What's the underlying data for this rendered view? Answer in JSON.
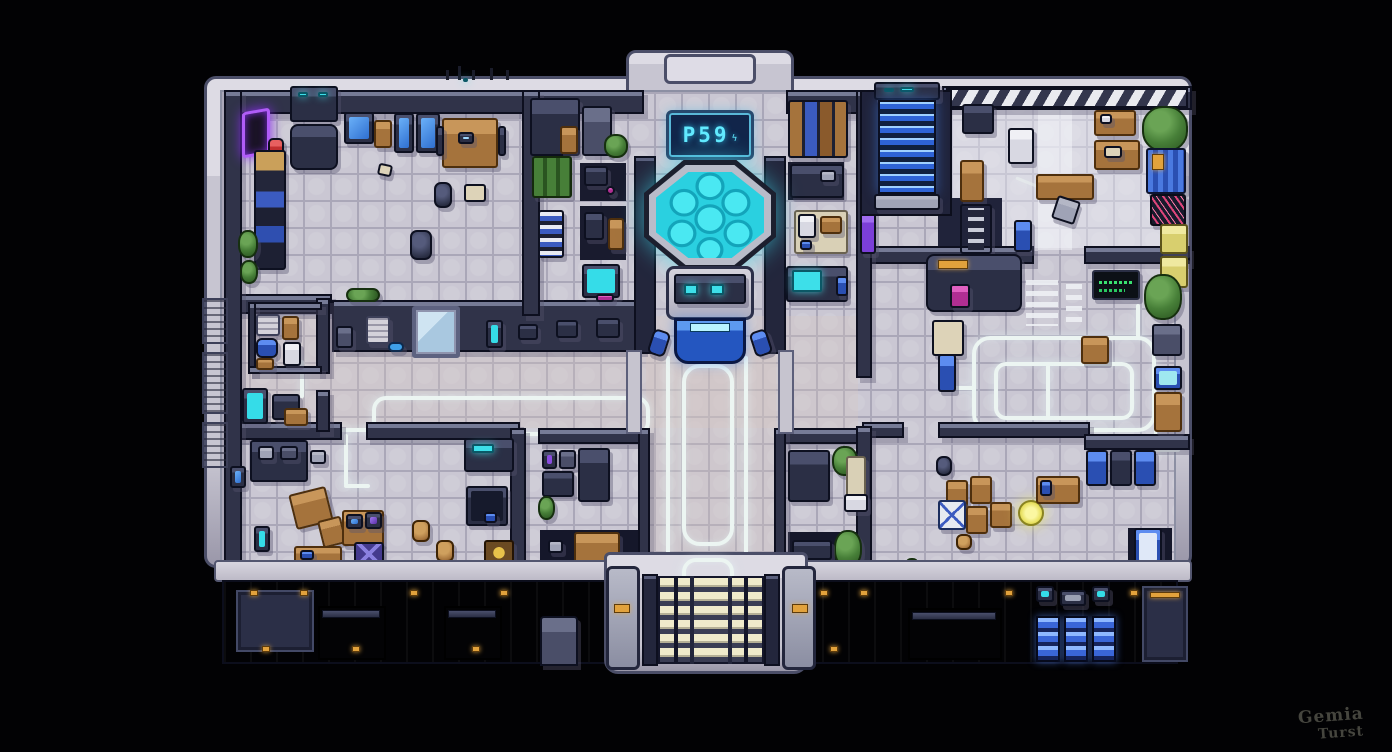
{
  "sign": {
    "text": "P59",
    "glyph": "ϟ"
  },
  "signature": {
    "line1": "Gemia",
    "line2": "Turst"
  },
  "palette": {
    "background": "#000000",
    "floor": "#cac7d3",
    "floor_grout": "#aaa7b8",
    "wall": "#303349",
    "wall_edge": "#9ba0b8",
    "outer_rim": "#c7c5d1",
    "glow_cyan": "#3ddfe9",
    "glow_path_white": "#ecf5f2",
    "stairs_blue": "#2e63d6",
    "entrance_steps_cream": "#efeacb",
    "wood": "#a5733c",
    "plant_green": "#477f38",
    "locker_blue": "#3a66d8",
    "accent_purple": "#b05cf8",
    "accent_magenta": "#b02e92",
    "accent_orange": "#e2a23c",
    "accent_red": "#c23030",
    "accent_yellow": "#e8e060",
    "graffiti_pink": "#e0457b",
    "terminal_green": "#3ae070"
  }
}
